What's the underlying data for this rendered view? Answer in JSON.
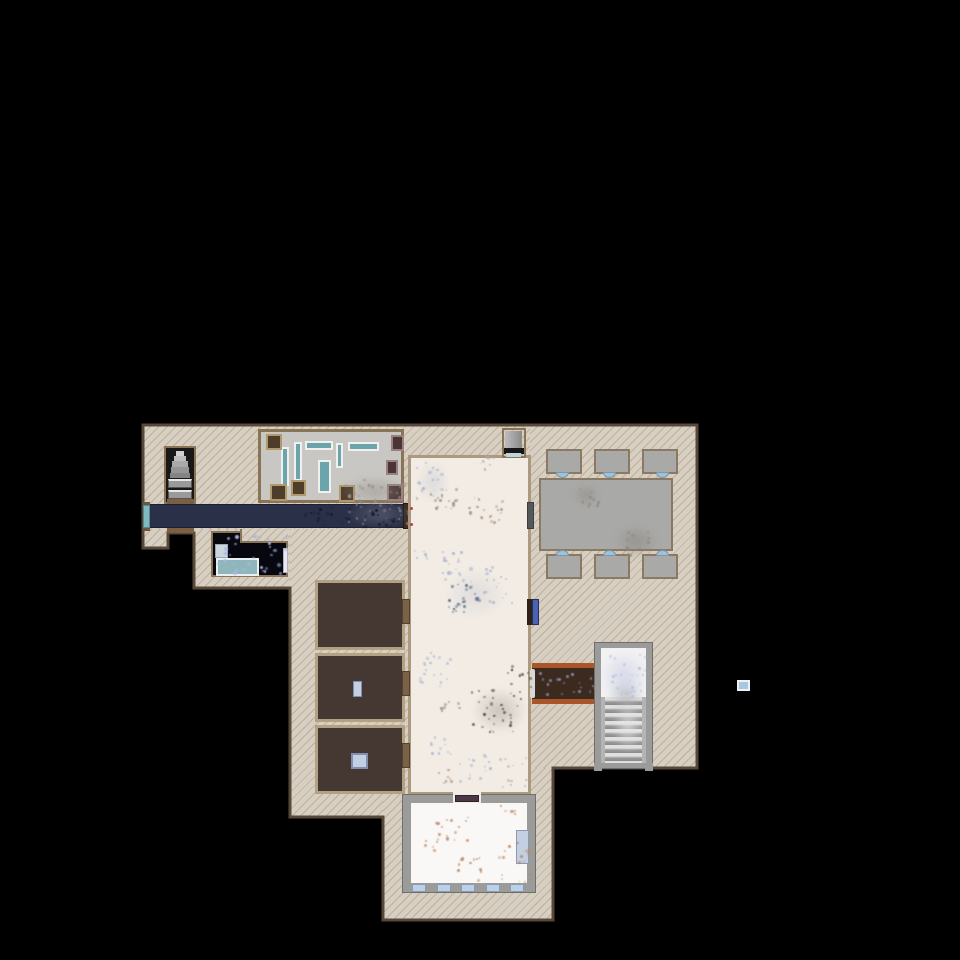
{
  "scene": {
    "kind": "top-down building floor plan, single storey, rendered on black void",
    "background": "#000000"
  },
  "colors": {
    "tan_floor": "#d7cfc1",
    "outline": "#57493a",
    "wall_brown": "#8a7456",
    "hall_floor": "#f2ece4",
    "hall_wall": "#ab9a80",
    "corridor_floor": "#2b3049",
    "corridor_door_teal": "#7fb9c2",
    "door_dark_brown": "#3f2e20",
    "dark_room_floor": "#07070f",
    "pool_water": "#8fb6ba",
    "pool_border": "#e8f0f2",
    "sink": "#ccd6de",
    "storage_floor": "#453731",
    "storage_wall": "#b2a183",
    "storage_door": "#7a6248",
    "dining_gray": "#a9a9a7",
    "dining_border": "#8a7a64",
    "chair_notch_blue": "#9ec2d8",
    "stair_alcove": "#181818",
    "landing_gray": "#9a9a9a",
    "threshold_brown": "#7a5f43",
    "workshop_floor": "#c9c7c3",
    "counter_teal": "#6ca4ac",
    "counter_border": "#f0f0ee",
    "crate_a_body": "#4f3d2c",
    "crate_a_border": "#b09a6a",
    "crate_b_body": "#4a3434",
    "crate_b_border": "#9a8080",
    "wood_table_body": "#3c2a1f",
    "wood_table_edge": "#a8562a",
    "stairwell_wall": "#9b9b99",
    "stairwell_floor": "#f2f2f4",
    "blue_unit": "#4a62b0",
    "gray_door": "#54585c",
    "bottom_room_wall": "#9b9b99",
    "bottom_room_floor": "#f9f8f6",
    "window_blue": "#bcd0e8",
    "window_border": "#8a9ab0",
    "niche_metal": "#9a9a9a",
    "niche_black": "#151515",
    "niche_sill": "#bcd4e0",
    "object_blue_light": "#c3d0e2",
    "red_dot": "#c04040",
    "lone_marker_fill": "#a8c8e0",
    "lone_marker_border": "#f0f0f0"
  },
  "rooms": [
    {
      "id": "stair-alcove",
      "purpose": "staircase going up, north-west"
    },
    {
      "id": "workshop-room",
      "purpose": "grey room with teal counters and crates"
    },
    {
      "id": "corridor",
      "purpose": "long dark navy hallway"
    },
    {
      "id": "washroom",
      "purpose": "dark room with sink and teal basin"
    },
    {
      "id": "great-hall",
      "purpose": "large cream central hall with debris"
    },
    {
      "id": "dining-room",
      "purpose": "grey table with six chairs"
    },
    {
      "id": "storage-room-1",
      "purpose": "dark brown room"
    },
    {
      "id": "storage-room-2",
      "purpose": "dark brown room with small blue object"
    },
    {
      "id": "storage-room-3",
      "purpose": "dark brown room with blue crate"
    },
    {
      "id": "stairwell-down",
      "purpose": "staircase going down, east side"
    },
    {
      "id": "south-room",
      "purpose": "white room with five windows on south wall"
    }
  ],
  "debris_patches": [
    {
      "x": 413,
      "y": 461,
      "w": 28,
      "h": 38,
      "color": "#a8b2cc",
      "count": 20
    },
    {
      "x": 426,
      "y": 486,
      "w": 30,
      "h": 22,
      "color": "#9a8d80",
      "count": 16
    },
    {
      "x": 468,
      "y": 497,
      "w": 34,
      "h": 24,
      "color": "#ab9483",
      "count": 18
    },
    {
      "x": 479,
      "y": 455,
      "w": 18,
      "h": 14,
      "color": "#b0a89c",
      "count": 8
    },
    {
      "x": 440,
      "y": 550,
      "w": 32,
      "h": 36,
      "color": "#a8b2cc",
      "count": 20
    },
    {
      "x": 448,
      "y": 583,
      "w": 30,
      "h": 28,
      "color": "#5c6c88",
      "count": 24
    },
    {
      "x": 482,
      "y": 566,
      "w": 30,
      "h": 36,
      "color": "#a8b2cc",
      "count": 18
    },
    {
      "x": 414,
      "y": 543,
      "w": 14,
      "h": 16,
      "color": "#a8b2cc",
      "count": 6
    },
    {
      "x": 415,
      "y": 650,
      "w": 36,
      "h": 36,
      "color": "#aab6d0",
      "count": 20
    },
    {
      "x": 470,
      "y": 686,
      "w": 52,
      "h": 46,
      "color": "#4a443e",
      "count": 30
    },
    {
      "x": 437,
      "y": 700,
      "w": 22,
      "h": 18,
      "color": "#9a8d80",
      "count": 8
    },
    {
      "x": 428,
      "y": 736,
      "w": 24,
      "h": 24,
      "color": "#aab6d0",
      "count": 10
    },
    {
      "x": 458,
      "y": 752,
      "w": 36,
      "h": 28,
      "color": "#aab6d0",
      "count": 14
    },
    {
      "x": 498,
      "y": 755,
      "w": 28,
      "h": 32,
      "color": "#b0aaa2",
      "count": 12
    },
    {
      "x": 432,
      "y": 768,
      "w": 22,
      "h": 16,
      "color": "#ab9483",
      "count": 8
    },
    {
      "x": 505,
      "y": 664,
      "w": 26,
      "h": 34,
      "color": "#4a443e",
      "count": 14
    },
    {
      "x": 214,
      "y": 534,
      "w": 72,
      "h": 40,
      "color": "#aab4e0",
      "count": 30,
      "smin": 2,
      "smax": 4
    },
    {
      "x": 300,
      "y": 506,
      "w": 108,
      "h": 20,
      "color": "#121528",
      "count": 34
    },
    {
      "x": 342,
      "y": 478,
      "w": 62,
      "h": 26,
      "color": "#98928a",
      "count": 30
    },
    {
      "x": 348,
      "y": 502,
      "w": 60,
      "h": 24,
      "color": "#8d8d98",
      "count": 24
    },
    {
      "x": 576,
      "y": 487,
      "w": 22,
      "h": 18,
      "color": "#8d8880",
      "count": 12
    },
    {
      "x": 622,
      "y": 530,
      "w": 30,
      "h": 26,
      "color": "#8d8880",
      "count": 16
    },
    {
      "x": 604,
      "y": 652,
      "w": 42,
      "h": 44,
      "color": "#b4c0e2",
      "count": 26
    },
    {
      "x": 538,
      "y": 671,
      "w": 56,
      "h": 25,
      "color": "#9098b8",
      "count": 20
    },
    {
      "x": 433,
      "y": 812,
      "w": 34,
      "h": 30,
      "color": "#bb8666",
      "count": 16
    },
    {
      "x": 455,
      "y": 856,
      "w": 30,
      "h": 24,
      "color": "#bb8666",
      "count": 12
    },
    {
      "x": 497,
      "y": 841,
      "w": 34,
      "h": 40,
      "color": "#bb8666",
      "count": 18
    },
    {
      "x": 420,
      "y": 838,
      "w": 18,
      "h": 14,
      "color": "#bb8666",
      "count": 6
    },
    {
      "x": 500,
      "y": 804,
      "w": 16,
      "h": 10,
      "color": "#bb8666",
      "count": 5
    }
  ],
  "smudges": [
    {
      "x": 340,
      "y": 476,
      "w": 70,
      "h": 30,
      "color": "rgba(150,145,138,0.55)"
    },
    {
      "x": 346,
      "y": 500,
      "w": 66,
      "h": 28,
      "color": "rgba(125,125,140,0.5)"
    },
    {
      "x": 614,
      "y": 524,
      "w": 44,
      "h": 34,
      "color": "rgba(135,130,120,0.5)"
    },
    {
      "x": 572,
      "y": 484,
      "w": 28,
      "h": 22,
      "color": "rgba(135,130,120,0.45)"
    },
    {
      "x": 600,
      "y": 650,
      "w": 48,
      "h": 52,
      "color": "rgba(195,200,224,0.6)"
    },
    {
      "x": 608,
      "y": 680,
      "w": 36,
      "h": 30,
      "color": "rgba(165,165,170,0.55)"
    },
    {
      "x": 612,
      "y": 698,
      "w": 32,
      "h": 56,
      "color": "rgba(230,230,232,0.75)"
    },
    {
      "x": 445,
      "y": 570,
      "w": 60,
      "h": 48,
      "color": "rgba(175,182,205,0.3)"
    },
    {
      "x": 472,
      "y": 688,
      "w": 55,
      "h": 45,
      "color": "rgba(95,88,82,0.28)"
    },
    {
      "x": 418,
      "y": 462,
      "w": 30,
      "h": 40,
      "color": "rgba(175,182,205,0.35)"
    }
  ],
  "red_marks": [
    {
      "x": 410,
      "y": 507
    },
    {
      "x": 410,
      "y": 523
    }
  ],
  "outline_points": "143,425 697,425 697,768 553,768 553,920 383,920 383,817 290,817 290,588 194,588 194,533 168,533 168,548 143,548"
}
